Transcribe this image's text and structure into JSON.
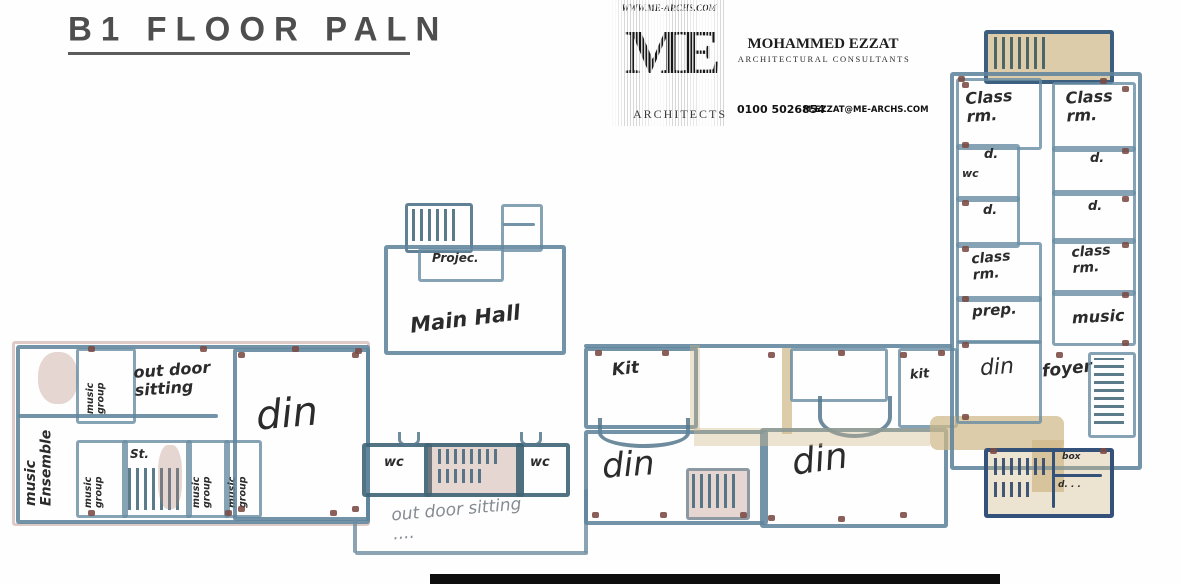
{
  "title": "B1 FLOOR PALN",
  "logo": {
    "website": "WWW.ME-ARCHS.COM",
    "monogram": "ME",
    "wordmark": "ARCHITECTS",
    "name": "MOHAMMED EZZAT",
    "tagline": "ARCHITECTURAL CONSULTANTS",
    "phone": "0100 5026854",
    "email": "M.EZZAT@ME-ARCHS.COM"
  },
  "rooms": {
    "music_ensemble": "music Ensemble",
    "music_group": "music group",
    "outdoor_sitting": "out door sitting",
    "stair": "St.",
    "din": "din",
    "projection": "Projec.",
    "main_hall": "Main Hall",
    "kitchen": "Kit",
    "kitchen_small": "kit",
    "wc": "wc",
    "outdoor_sitting_lower": "out door sitting ....",
    "class_rm": "Class rm.",
    "class_rm_lower": "class rm.",
    "dressing": "d.",
    "prep": "prep.",
    "music": "music",
    "foyer": "foyer",
    "box": "box",
    "d_small": "d. . ."
  }
}
